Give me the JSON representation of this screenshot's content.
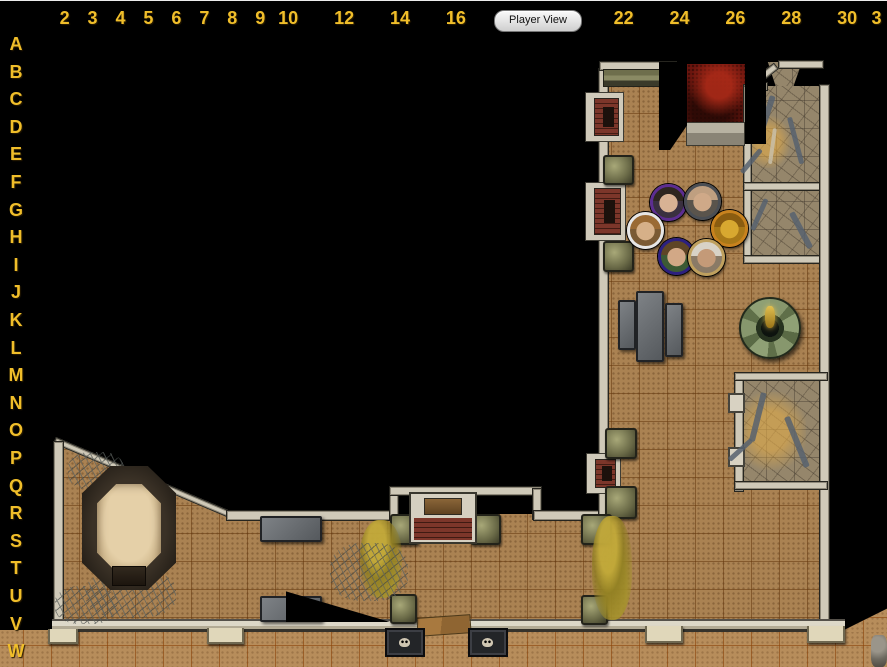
{
  "toolbar": {
    "player_view_label": "Player View"
  },
  "colors": {
    "background": "#000000",
    "ruler_text": "#f0be2a",
    "interior_floor": "#aa8252",
    "exterior_floor": "#b78d5b",
    "stone_floor": "#95866b",
    "blood_room": "#6b150e",
    "wall_cap": "#cfc9b8"
  },
  "rulers": {
    "top_labels": [
      {
        "t": "2",
        "c": 2
      },
      {
        "t": "3",
        "c": 3
      },
      {
        "t": "4",
        "c": 4
      },
      {
        "t": "5",
        "c": 5
      },
      {
        "t": "6",
        "c": 6
      },
      {
        "t": "7",
        "c": 7
      },
      {
        "t": "8",
        "c": 8
      },
      {
        "t": "9",
        "c": 9
      },
      {
        "t": "10",
        "c": 10
      },
      {
        "t": "12",
        "c": 12
      },
      {
        "t": "14",
        "c": 14
      },
      {
        "t": "16",
        "c": 16
      },
      {
        "t": "22",
        "c": 22
      },
      {
        "t": "24",
        "c": 24
      },
      {
        "t": "26",
        "c": 26
      },
      {
        "t": "28",
        "c": 28
      },
      {
        "t": "30",
        "c": 30
      },
      {
        "t": "3",
        "c": 31.05
      }
    ],
    "left_labels": [
      "A",
      "B",
      "C",
      "D",
      "E",
      "F",
      "G",
      "H",
      "I",
      "J",
      "K",
      "L",
      "M",
      "N",
      "O",
      "P",
      "Q",
      "R",
      "S",
      "T",
      "U",
      "V",
      "W"
    ]
  },
  "map": {
    "grid_cell_px": 28,
    "elements": [
      {
        "name": "exterior-floor-strip",
        "type": "floor-ext",
        "x": 0,
        "y": 630,
        "w": 887,
        "h": 37
      },
      {
        "name": "exterior-floor-right-slope",
        "type": "floor-ext",
        "x": 840,
        "y": 606,
        "w": 47,
        "h": 26,
        "clip": "polygon(0 100%,100% 10%,100% 100%)"
      },
      {
        "name": "north-corridor-floor",
        "type": "floor-int",
        "x": 606,
        "y": 74,
        "w": 139,
        "h": 190
      },
      {
        "name": "great-hall-floor",
        "type": "floor-int",
        "x": 606,
        "y": 256,
        "w": 216,
        "h": 366
      },
      {
        "name": "south-hall-floor",
        "type": "floor-int",
        "x": 388,
        "y": 514,
        "w": 220,
        "h": 108
      },
      {
        "name": "pit-room-floor",
        "type": "floor-int",
        "x": 60,
        "y": 441,
        "w": 330,
        "h": 181,
        "clip": "polygon(0 0,52% 43%,100% 43%,100% 100%,0 100%)"
      },
      {
        "name": "blood-room-floor",
        "type": "floor-red",
        "x": 687,
        "y": 64,
        "w": 58,
        "h": 62
      },
      {
        "name": "passage-floor",
        "type": "floor-stone",
        "x": 764,
        "y": 62,
        "w": 38,
        "h": 28,
        "clip": "polygon(10% 0,100% 0,74% 100%,34% 100%)"
      },
      {
        "name": "rubble-room-1-floor",
        "type": "floor-stone",
        "x": 748,
        "y": 86,
        "w": 74,
        "h": 99
      },
      {
        "name": "rubble-room-2-floor",
        "type": "floor-stone",
        "x": 748,
        "y": 188,
        "w": 74,
        "h": 70
      },
      {
        "name": "rubble-room-3-floor",
        "type": "floor-stone",
        "x": 738,
        "y": 376,
        "w": 84,
        "h": 110
      },
      {
        "name": "rubble-room-3-glow",
        "type": "glow",
        "x": 742,
        "y": 392,
        "w": 64,
        "h": 78
      },
      {
        "name": "rubble-room-1-glow",
        "type": "glow",
        "x": 750,
        "y": 116,
        "w": 40,
        "h": 52
      },
      {
        "name": "pit-room-diagonal-wall",
        "type": "wall-cap",
        "x": 56,
        "y": 437,
        "w": 192,
        "h": 5,
        "rot": 23
      },
      {
        "name": "pit-room-left-wall",
        "type": "wall-v",
        "x": 53,
        "y": 441,
        "w": 9,
        "h": 181
      },
      {
        "name": "south-hall-top-wall-west",
        "type": "wall-h",
        "x": 226,
        "y": 510,
        "w": 165,
        "h": 9
      },
      {
        "name": "alcove-left-wall",
        "type": "wall-v",
        "x": 389,
        "y": 488,
        "w": 8,
        "h": 30
      },
      {
        "name": "alcove-top-wall",
        "type": "wall-h",
        "x": 389,
        "y": 486,
        "w": 151,
        "h": 8
      },
      {
        "name": "alcove-right-wall",
        "type": "wall-v",
        "x": 532,
        "y": 488,
        "w": 8,
        "h": 30
      },
      {
        "name": "south-hall-top-wall-east",
        "type": "wall-h",
        "x": 533,
        "y": 510,
        "w": 75,
        "h": 9
      },
      {
        "name": "corridor-west-wall",
        "type": "wall-v",
        "x": 598,
        "y": 68,
        "w": 9,
        "h": 446
      },
      {
        "name": "corridor-top-cap",
        "type": "wall-h",
        "x": 599,
        "y": 61,
        "w": 76,
        "h": 8
      },
      {
        "name": "stair-lintel",
        "type": "lintel",
        "x": 603,
        "y": 69,
        "w": 68,
        "h": 16
      },
      {
        "name": "rubble-rooms-west-wall",
        "type": "wall-v",
        "x": 743,
        "y": 84,
        "w": 7,
        "h": 174
      },
      {
        "name": "rubble-room-divider-wall",
        "type": "wall-h",
        "x": 743,
        "y": 182,
        "w": 84,
        "h": 7
      },
      {
        "name": "rubble-room-2-bottom-wall",
        "type": "wall-h",
        "x": 743,
        "y": 255,
        "w": 84,
        "h": 7
      },
      {
        "name": "east-main-wall",
        "type": "wall-v",
        "x": 819,
        "y": 84,
        "w": 9,
        "h": 538
      },
      {
        "name": "passage-top-cap",
        "type": "wall-h",
        "x": 778,
        "y": 60,
        "w": 44,
        "h": 7
      },
      {
        "name": "passage-diagonal-wall",
        "type": "wall-cap",
        "x": 744,
        "y": 86,
        "w": 36,
        "h": 6,
        "rot": -38
      },
      {
        "name": "rubble-room-1-top-cap",
        "type": "wall-h",
        "x": 746,
        "y": 82,
        "w": 20,
        "h": 7
      },
      {
        "name": "rubble-room-3-left-wall",
        "type": "wall-v",
        "x": 734,
        "y": 372,
        "w": 8,
        "h": 118
      },
      {
        "name": "rubble-room-3-top-wall",
        "type": "wall-h",
        "x": 734,
        "y": 372,
        "w": 92,
        "h": 7
      },
      {
        "name": "rubble-room-3-bottom-wall",
        "type": "wall-h",
        "x": 734,
        "y": 481,
        "w": 92,
        "h": 7
      },
      {
        "name": "door-jamb-upper",
        "type": "stub",
        "x": 728,
        "y": 393,
        "w": 13,
        "h": 16
      },
      {
        "name": "door-jamb-lower",
        "type": "stub",
        "x": 728,
        "y": 447,
        "w": 13,
        "h": 16
      },
      {
        "name": "south-outer-wall",
        "type": "wall-bottom",
        "x": 52,
        "y": 619,
        "w": 793,
        "h": 13
      },
      {
        "name": "buttress-1",
        "type": "buttress",
        "x": 48,
        "y": 629,
        "w": 26,
        "h": 13
      },
      {
        "name": "buttress-2",
        "type": "buttress",
        "x": 207,
        "y": 628,
        "w": 33,
        "h": 14
      },
      {
        "name": "buttress-3",
        "type": "buttress",
        "x": 645,
        "y": 626,
        "w": 34,
        "h": 15
      },
      {
        "name": "buttress-4",
        "type": "buttress",
        "x": 807,
        "y": 626,
        "w": 34,
        "h": 15
      },
      {
        "name": "south-gate-door",
        "type": "wood-door",
        "x": 417,
        "y": 616,
        "w": 52,
        "h": 17
      },
      {
        "name": "wall-shrine-1",
        "type": "shrine",
        "x": 585,
        "y": 92,
        "w": 37,
        "h": 48
      },
      {
        "name": "wall-shrine-2",
        "type": "shrine",
        "x": 585,
        "y": 182,
        "w": 39,
        "h": 57
      },
      {
        "name": "wall-shrine-3",
        "type": "shrine",
        "x": 586,
        "y": 453,
        "w": 33,
        "h": 39
      },
      {
        "name": "moss-statue-1",
        "type": "moss",
        "x": 603,
        "y": 155,
        "w": 27,
        "h": 26
      },
      {
        "name": "moss-statue-2",
        "type": "moss",
        "x": 603,
        "y": 241,
        "w": 27,
        "h": 27
      },
      {
        "name": "moss-statue-3",
        "type": "moss",
        "x": 605,
        "y": 428,
        "w": 28,
        "h": 27
      },
      {
        "name": "moss-statue-4",
        "type": "moss",
        "x": 605,
        "y": 486,
        "w": 28,
        "h": 29
      },
      {
        "name": "moss-statue-5",
        "type": "moss",
        "x": 581,
        "y": 514,
        "w": 27,
        "h": 27
      },
      {
        "name": "moss-statue-6",
        "type": "moss",
        "x": 390,
        "y": 514,
        "w": 25,
        "h": 27
      },
      {
        "name": "moss-statue-7",
        "type": "moss",
        "x": 470,
        "y": 514,
        "w": 27,
        "h": 27
      },
      {
        "name": "moss-statue-8",
        "type": "moss",
        "x": 390,
        "y": 594,
        "w": 23,
        "h": 26
      },
      {
        "name": "moss-statue-9",
        "type": "moss",
        "x": 581,
        "y": 595,
        "w": 23,
        "h": 26
      },
      {
        "name": "stone-slab-1",
        "type": "slab",
        "x": 618,
        "y": 300,
        "w": 14,
        "h": 46
      },
      {
        "name": "stone-slab-2",
        "type": "slab",
        "x": 636,
        "y": 291,
        "w": 24,
        "h": 67
      },
      {
        "name": "stone-slab-3",
        "type": "slab",
        "x": 665,
        "y": 303,
        "w": 14,
        "h": 50
      },
      {
        "name": "stone-slab-4",
        "type": "slab",
        "x": 260,
        "y": 516,
        "w": 58,
        "h": 22
      },
      {
        "name": "stone-slab-5",
        "type": "slab",
        "x": 260,
        "y": 596,
        "w": 58,
        "h": 22
      },
      {
        "name": "fountain",
        "type": "fountain",
        "x": 739,
        "y": 297,
        "w": 58,
        "h": 58
      },
      {
        "name": "brick-fireplace",
        "type": "fireplace",
        "x": 409,
        "y": 492,
        "w": 64,
        "h": 48
      },
      {
        "name": "skull-trapdoor-1",
        "type": "trapdoor",
        "x": 385,
        "y": 628,
        "w": 36,
        "h": 25
      },
      {
        "name": "skull-trapdoor-2",
        "type": "trapdoor",
        "x": 468,
        "y": 628,
        "w": 36,
        "h": 25
      },
      {
        "name": "gold-vine-1",
        "type": "vinegold",
        "x": 360,
        "y": 520,
        "w": 42,
        "h": 78
      },
      {
        "name": "gold-vine-2",
        "type": "vinegold",
        "x": 592,
        "y": 516,
        "w": 40,
        "h": 104
      },
      {
        "name": "thorn-vines-1",
        "type": "thorn",
        "x": 68,
        "y": 452,
        "w": 56,
        "h": 38
      },
      {
        "name": "thorn-vines-2",
        "type": "thorn",
        "x": 86,
        "y": 570,
        "w": 90,
        "h": 48
      },
      {
        "name": "thorn-vines-3",
        "type": "thorn",
        "x": 330,
        "y": 543,
        "w": 78,
        "h": 58
      },
      {
        "name": "thorn-vines-4",
        "type": "thorn",
        "x": 55,
        "y": 586,
        "w": 62,
        "h": 38
      },
      {
        "name": "sand-pit-rim",
        "type": "pit-outer",
        "x": 82,
        "y": 466,
        "w": 94,
        "h": 124
      },
      {
        "name": "sand-pit-floor",
        "type": "pit-sand",
        "x": 97,
        "y": 484,
        "w": 64,
        "h": 88
      },
      {
        "name": "sand-pit-step",
        "type": "pit-step",
        "x": 112,
        "y": 566,
        "w": 32,
        "h": 18
      },
      {
        "name": "rock-pile",
        "type": "rocks",
        "x": 871,
        "y": 635,
        "w": 16,
        "h": 32
      },
      {
        "name": "blood-room-steps",
        "type": "steps",
        "x": 686,
        "y": 122,
        "w": 57,
        "h": 22
      },
      {
        "name": "debris-1",
        "type": "debris",
        "x": 770,
        "y": 95,
        "w": 6,
        "h": 40,
        "rot": 18
      },
      {
        "name": "debris-2",
        "type": "debris",
        "x": 787,
        "y": 118,
        "w": 5,
        "h": 48,
        "rot": -15
      },
      {
        "name": "debris-3",
        "type": "debris",
        "x": 759,
        "y": 148,
        "w": 5,
        "h": 30,
        "rot": 40
      },
      {
        "name": "debris-bone",
        "type": "debris-light",
        "x": 773,
        "y": 128,
        "w": 4,
        "h": 36,
        "rot": 8
      },
      {
        "name": "debris-4",
        "type": "debris",
        "x": 764,
        "y": 198,
        "w": 5,
        "h": 34,
        "rot": 24
      },
      {
        "name": "debris-5",
        "type": "debris",
        "x": 789,
        "y": 214,
        "w": 6,
        "h": 40,
        "rot": -28
      },
      {
        "name": "debris-6",
        "type": "debris",
        "x": 761,
        "y": 392,
        "w": 6,
        "h": 50,
        "rot": 14
      },
      {
        "name": "debris-7",
        "type": "debris",
        "x": 784,
        "y": 418,
        "w": 6,
        "h": 54,
        "rot": -22
      },
      {
        "name": "debris-8",
        "type": "debris",
        "x": 750,
        "y": 438,
        "w": 5,
        "h": 30,
        "rot": 48
      },
      {
        "name": "fog-west-of-blood-room",
        "type": "fog",
        "x": 659,
        "y": 62,
        "w": 28,
        "h": 88,
        "clip": "polygon(0 0,100% 0,100% 72%,40% 100%,0 100%)"
      },
      {
        "name": "fog-east-of-blood-room",
        "type": "fog",
        "x": 745,
        "y": 60,
        "w": 21,
        "h": 84
      },
      {
        "name": "fog-hall-wedge",
        "type": "fog",
        "x": 286,
        "y": 588,
        "w": 104,
        "h": 34,
        "clip": "polygon(0 10%,100% 100%,0 100%)"
      }
    ],
    "tokens": [
      {
        "name": "token-purple-woman",
        "cx": 668,
        "cy": 202,
        "ring": "#5c2d91",
        "hair": "#2e2620",
        "skin": "#d8b294",
        "body": "#3a3040"
      },
      {
        "name": "token-gray-bald-man",
        "cx": 702,
        "cy": 201,
        "ring": "#4a4e54",
        "hair": "#bf9f80",
        "skin": "#cfa988",
        "body": "#5a544c"
      },
      {
        "name": "token-white-curly-hair",
        "cx": 645,
        "cy": 230,
        "ring": "#e6e6e6",
        "hair": "#9a6a34",
        "skin": "#d6b088",
        "body": "#7a5a34"
      },
      {
        "name": "token-gold-figure",
        "cx": 729,
        "cy": 228,
        "ring": "#c8821e",
        "hair": "#8a5c10",
        "skin": "#d8a830",
        "body": "#a87818"
      },
      {
        "name": "token-blue-green-garb",
        "cx": 676,
        "cy": 256,
        "ring": "#2c2080",
        "hair": "#5e4526",
        "skin": "#d2a886",
        "body": "#3c5a34"
      },
      {
        "name": "token-tan-old-man",
        "cx": 706,
        "cy": 257,
        "ring": "#bfa05e",
        "hair": "#d8d2c6",
        "skin": "#c49a78",
        "body": "#8a7a66"
      }
    ]
  }
}
